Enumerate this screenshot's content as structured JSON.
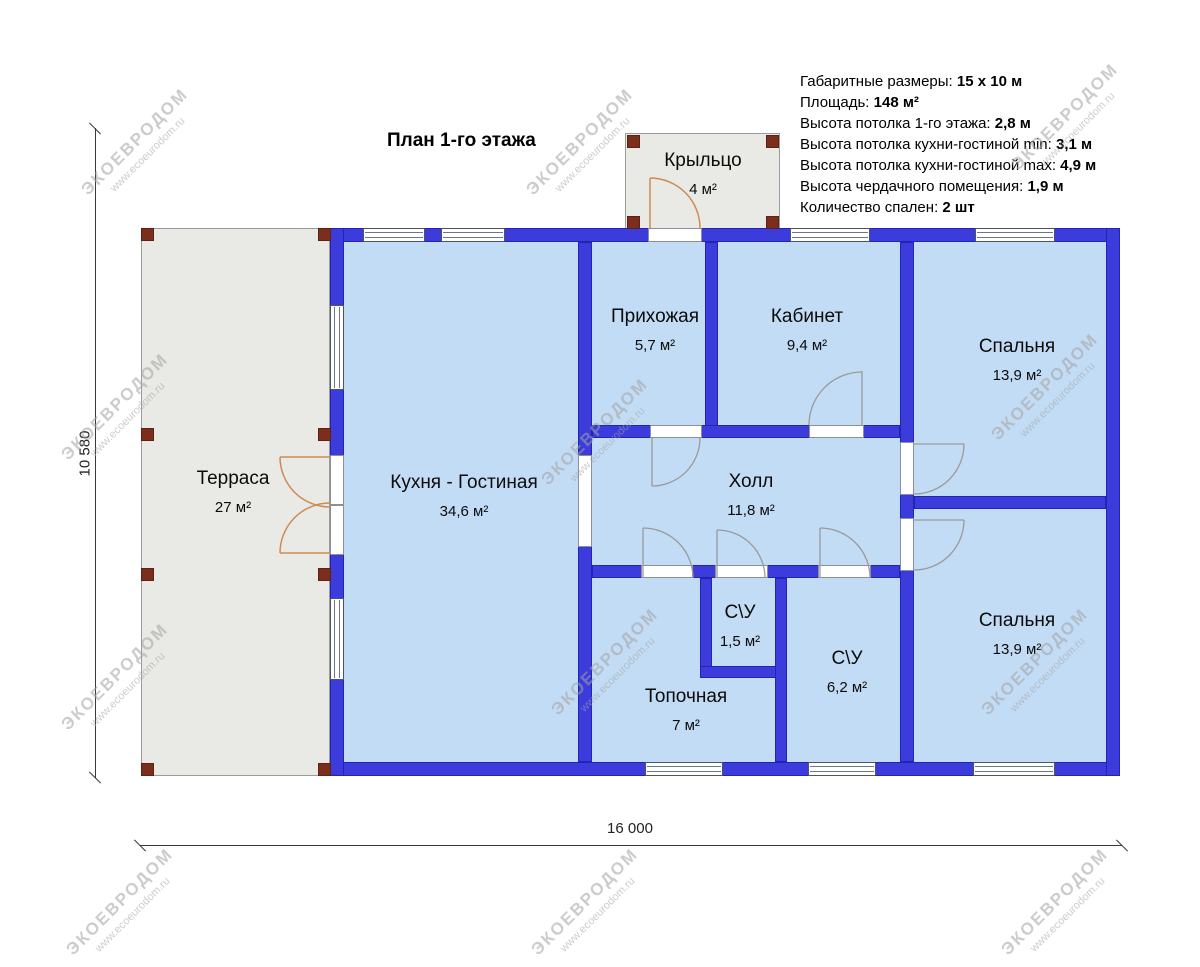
{
  "title": "План 1-го этажа",
  "specs": [
    {
      "label": "Габаритные размеры: ",
      "value": "15 x 10 м"
    },
    {
      "label": "Площадь: ",
      "value": "148 м²"
    },
    {
      "label": "Высота потолка 1-го этажа: ",
      "value": "2,8 м"
    },
    {
      "label": "Высота потолка кухни-гостиной min: ",
      "value": "3,1 м"
    },
    {
      "label": "Высота потолка кухни-гостиной max: ",
      "value": "4,9 м"
    },
    {
      "label": "Высота чердачного помещения: ",
      "value": "1,9 м"
    },
    {
      "label": "Количество спален: ",
      "value": "2 шт"
    }
  ],
  "rooms": {
    "porch": {
      "name": "Крыльцо",
      "area": "4 м²"
    },
    "terrace": {
      "name": "Терраса",
      "area": "27 м²"
    },
    "kitchen_living": {
      "name": "Кухня - Гостиная",
      "area": "34,6 м²"
    },
    "entry": {
      "name": "Прихожая",
      "area": "5,7 м²"
    },
    "office": {
      "name": "Кабинет",
      "area": "9,4 м²"
    },
    "bedroom_top": {
      "name": "Спальня",
      "area": "13,9 м²"
    },
    "hall": {
      "name": "Холл",
      "area": "11,8 м²"
    },
    "wc_small": {
      "name": "С\\У",
      "area": "1,5 м²"
    },
    "boiler": {
      "name": "Топочная",
      "area": "7 м²"
    },
    "wc_big": {
      "name": "С\\У",
      "area": "6,2 м²"
    },
    "bedroom_bottom": {
      "name": "Спальня",
      "area": "13,9 м²"
    }
  },
  "dimensions": {
    "width": "16 000",
    "height": "10 580"
  },
  "watermark": {
    "line1": "ЭКОЕВРОДОМ",
    "line2": "www.ecoeurodom.ru"
  },
  "colors": {
    "wall": "#3c3cdc",
    "room_fill": "#c3dcf5",
    "terrace_fill": "#e9e9e6",
    "post": "#7c2e1d",
    "exterior_door_arc": "#cf8a52",
    "interior_door_arc": "#9a9a9a"
  }
}
